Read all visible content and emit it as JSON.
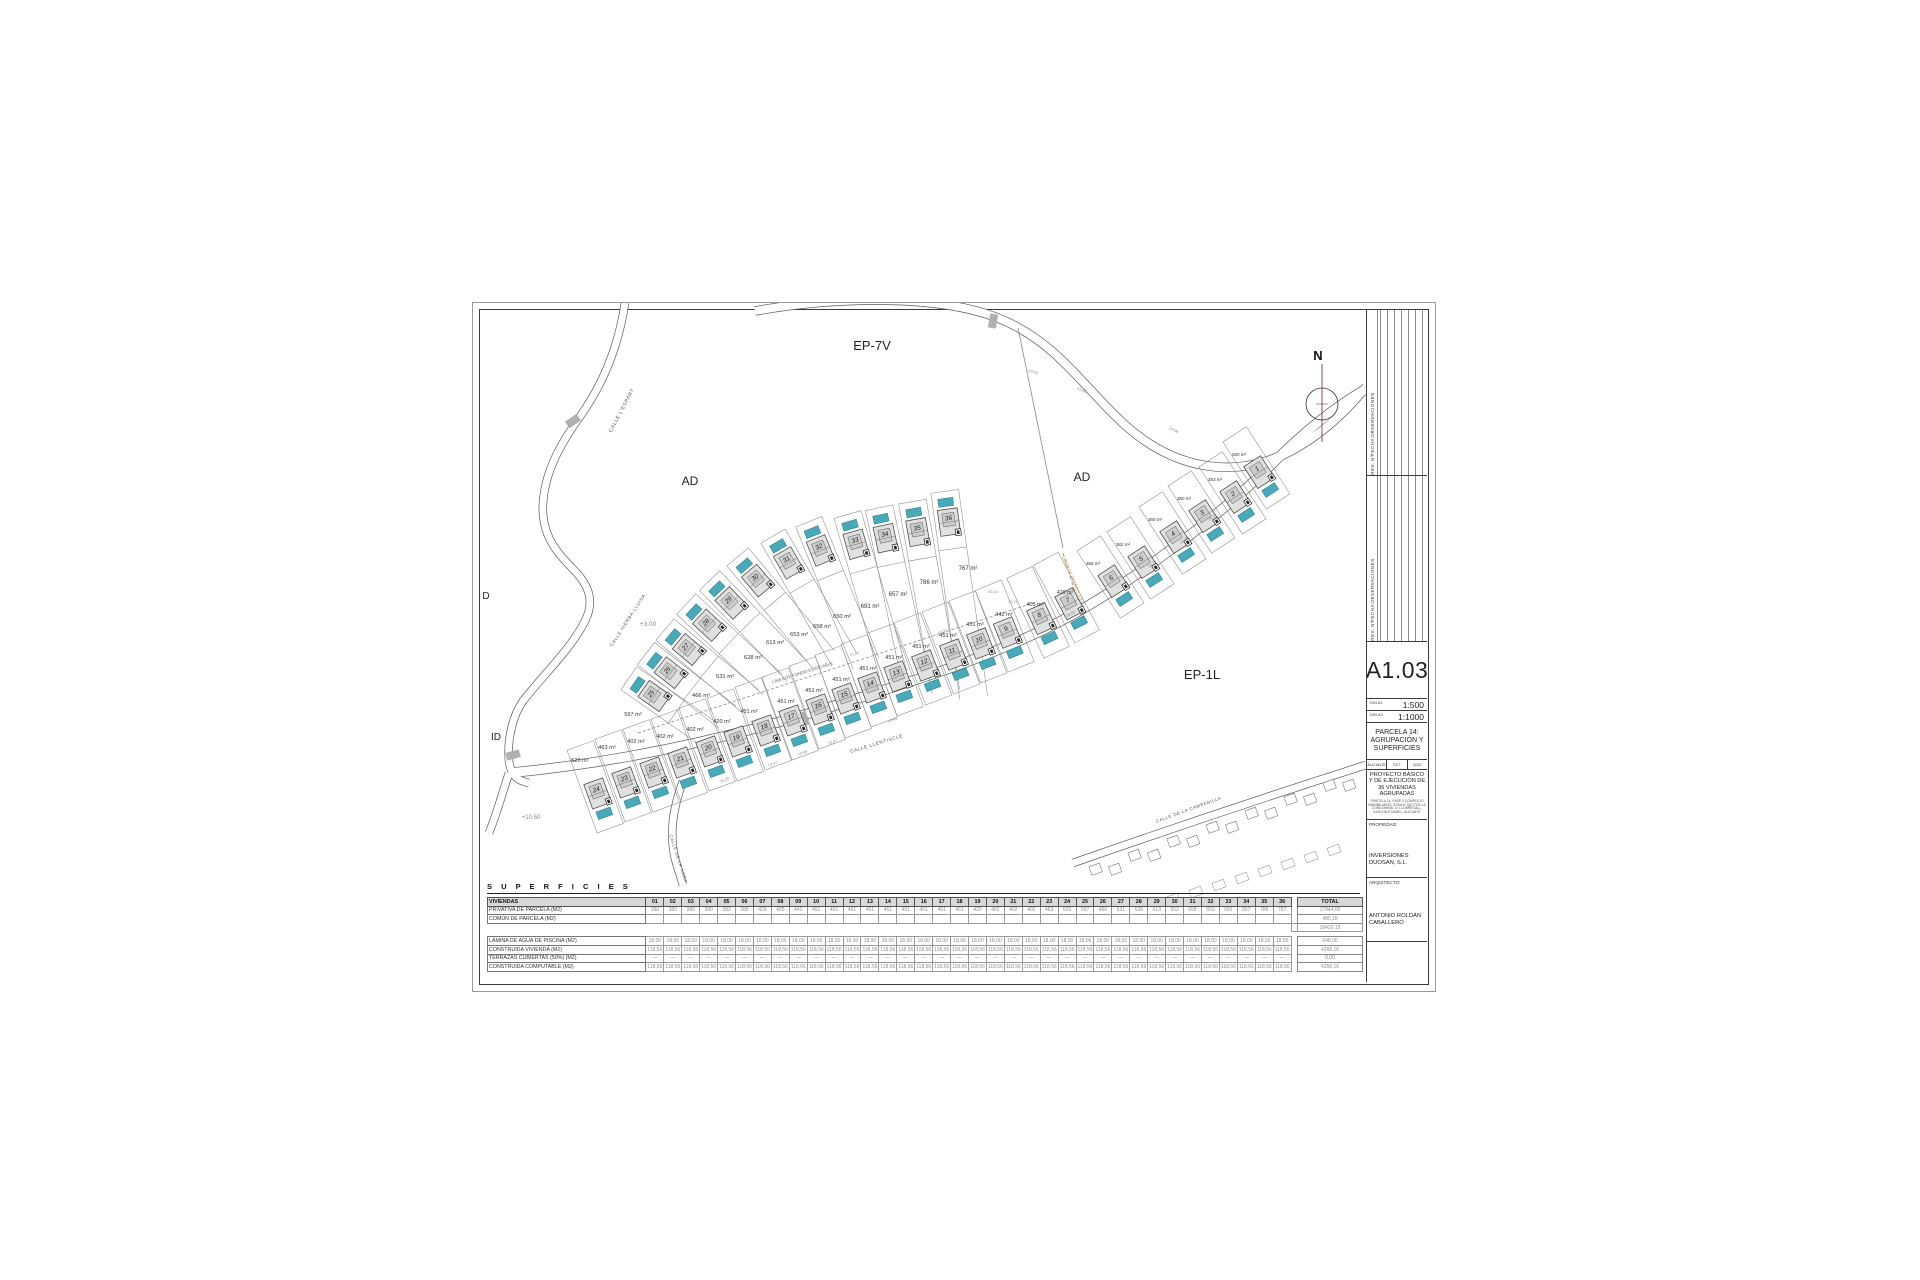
{
  "sheet": {
    "code": "A1.03",
    "scales": [
      {
        "din": "DIN A1",
        "value": "1:500"
      },
      {
        "din": "DIN A3",
        "value": "1:1000"
      }
    ],
    "drawing_title": "PARCELA 14: AGRUPACIÓN Y SUPERFICIES",
    "meta": [
      "ALICANTE",
      "OCT.",
      "2022"
    ],
    "project": "PROYECTO BÁSICO Y DE EJECUCIÓN DE 36 VIVIENDAS AGRUPADAS",
    "project_address": "PARCELA 14, FASE 3 COMPLEJO INMOBILIARIO, ZONA E SECTOR LA CONDOMINA, C/ LLOBREGALL, 03110 MUTXAMEL, ALICANTE",
    "owner_label": "PROPIEDAD:",
    "owner": "INVERSIONES DUOSAN, S.L.",
    "architect_label": "ARQUITECTO:",
    "architect": "ANTONIO ROLDÁN CABALLERO",
    "revision_headers": [
      "OBSERVACIONES",
      "FECHA",
      "REV. Nº"
    ]
  },
  "plan": {
    "colors": {
      "pool": "#4aa9b8",
      "pool_stroke": "#2e8492",
      "house_fill": "#e0e0e0",
      "line": "#3c3c3c",
      "parcel": "#8a8a8a",
      "accent_orange": "#c49a4a",
      "north_line": "#8b3a3a"
    },
    "north": {
      "x": 849,
      "y": 101,
      "label": "N"
    },
    "region_labels": [
      {
        "text": "EP-7V",
        "x": 399,
        "y": 47,
        "size": 13
      },
      {
        "text": "AD",
        "x": 217,
        "y": 182,
        "size": 12
      },
      {
        "text": "AD",
        "x": 609,
        "y": 178,
        "size": 12
      },
      {
        "text": "EP-1L",
        "x": 729,
        "y": 376,
        "size": 13
      },
      {
        "text": "ID",
        "x": 23,
        "y": 437,
        "size": 10
      },
      {
        "text": "D",
        "x": 13,
        "y": 296,
        "size": 10
      }
    ],
    "street_labels": [
      {
        "text": "CALLE  L'ESPART",
        "x": 150,
        "y": 108,
        "rot": -62,
        "size": 5
      },
      {
        "text": "CALLE HIERBA-LLUISA",
        "x": 156,
        "y": 318,
        "rot": -57,
        "size": 4.6
      },
      {
        "text": "CALLE LLENTISCLE",
        "x": 404,
        "y": 442,
        "rot": -17,
        "size": 4.8
      },
      {
        "text": "CALLE DE LA XARA",
        "x": 204,
        "y": 556,
        "rot": 72,
        "size": 4.4
      },
      {
        "text": "CALLE DE LA CAMPANILLA",
        "x": 716,
        "y": 508,
        "rot": -20,
        "size": 4.4
      }
    ],
    "annotations": [
      {
        "text": "LÍNEA DE FONDO EDIFICABLE",
        "x": 330,
        "y": 371,
        "rot": -17.5,
        "size": 4.4,
        "color": "#666666"
      },
      {
        "text": "LÍNEA DE RETRANQUEO",
        "x": 599,
        "y": 278,
        "rot": 68,
        "size": 4.4,
        "color": "#c49a4a"
      },
      {
        "text": "+3.00",
        "x": 175,
        "y": 323,
        "rot": 0,
        "size": 6.5,
        "color": "#888888"
      },
      {
        "text": "+10.50",
        "x": 58,
        "y": 516,
        "rot": 0,
        "size": 6,
        "color": "#888888"
      }
    ],
    "dims": [
      {
        "text": "13,47",
        "x": 300,
        "y": 462,
        "rot": -20
      },
      {
        "text": "13,46",
        "x": 330,
        "y": 451,
        "rot": -20
      },
      {
        "text": "13,47",
        "x": 360,
        "y": 440,
        "rot": -20
      },
      {
        "text": "15,25",
        "x": 252,
        "y": 478,
        "rot": -20
      },
      {
        "text": "13,41",
        "x": 420,
        "y": 418,
        "rot": -20
      },
      {
        "text": "16,02",
        "x": 560,
        "y": 70,
        "rot": 18
      },
      {
        "text": "13,50",
        "x": 608,
        "y": 88,
        "rot": 22
      },
      {
        "text": "14,08",
        "x": 700,
        "y": 128,
        "rot": 30
      },
      {
        "text": "16,19",
        "x": 740,
        "y": 215,
        "rot": -35
      },
      {
        "text": "16,28",
        "x": 712,
        "y": 238,
        "rot": -35
      },
      {
        "text": "16,22",
        "x": 680,
        "y": 262,
        "rot": -35
      },
      {
        "text": "18,55",
        "x": 598,
        "y": 312,
        "rot": -25
      },
      {
        "text": "20,24",
        "x": 520,
        "y": 290,
        "rot": 0
      },
      {
        "text": "11,72",
        "x": 540,
        "y": 300,
        "rot": 0
      },
      {
        "text": "13,27",
        "x": 470,
        "y": 330,
        "rot": -18
      },
      {
        "text": "21,81",
        "x": 382,
        "y": 352,
        "rot": -18
      }
    ],
    "roads": [
      {
        "d": "M152,0 C146,40 132,78 108,112 C88,140 72,168 70,200 C68,232 84,250 100,266 C116,282 122,298 112,318 C98,346 70,372 50,398 C40,412 34,436 36,458 C38,472 44,478 56,480",
        "w": 7
      },
      {
        "d": "M282,8 C360,-6 470,-10 532,18 C586,42 612,86 652,122 C700,165 760,178 818,148 C846,133 872,110 893,84",
        "w": 8
      },
      {
        "d": "M36,470 C140,460 250,438 370,400 C460,372 520,352 580,322 C620,302 660,275 700,245 C740,215 775,185 800,160 C830,130 860,105 893,86",
        "w": 9
      },
      {
        "d": "M210,478 C200,505 196,530 202,556 L210,582",
        "w": 7
      },
      {
        "d": "M600,560 C680,532 780,498 893,462",
        "w": 7
      },
      {
        "d": "M36,470 C30,488 24,510 16,530",
        "w": 7
      }
    ],
    "boundary_lines": [
      {
        "d": "M545,25 L590,245",
        "dash": ""
      },
      {
        "d": "M165,430 L560,300",
        "dash": "3,2"
      },
      {
        "d": "M590,250 L612,322",
        "dash": "4,2"
      }
    ],
    "crossings": [
      {
        "x": 100,
        "y": 118,
        "rot": 55
      },
      {
        "x": 520,
        "y": 18,
        "rot": 10
      },
      {
        "x": 40,
        "y": 452,
        "rot": 75
      },
      {
        "x": 330,
        "y": 416,
        "rot": -18
      }
    ],
    "rows": [
      {
        "name": "upper",
        "poolSide": -1,
        "parcel": [
          14,
          38,
          20
        ],
        "plots": [
          {
            "n": 25,
            "x": 187,
            "y": 397,
            "a": -55
          },
          {
            "n": 26,
            "x": 203,
            "y": 374,
            "a": -52
          },
          {
            "n": 27,
            "x": 221,
            "y": 351,
            "a": -50
          },
          {
            "n": 28,
            "x": 241,
            "y": 327,
            "a": -47
          },
          {
            "n": 29,
            "x": 263,
            "y": 305,
            "a": -44
          },
          {
            "n": 30,
            "x": 289,
            "y": 283,
            "a": -40
          },
          {
            "n": 31,
            "x": 319,
            "y": 266,
            "a": -30
          },
          {
            "n": 32,
            "x": 350,
            "y": 254,
            "a": -22
          },
          {
            "n": 33,
            "x": 385,
            "y": 248,
            "a": -16
          },
          {
            "n": 34,
            "x": 414,
            "y": 242,
            "a": -12
          },
          {
            "n": 35,
            "x": 446,
            "y": 236,
            "a": -10
          },
          {
            "n": 36,
            "x": 477,
            "y": 226,
            "a": -8
          }
        ],
        "tails": [
          40,
          45,
          52,
          60,
          68,
          76,
          84,
          95,
          108,
          120,
          135,
          150
        ]
      },
      {
        "name": "lower",
        "poolSide": 1,
        "parcel": [
          14,
          58,
          30
        ],
        "plots": [
          {
            "n": 24,
            "x": 127,
            "y": 497,
            "a": -20
          },
          {
            "n": 23,
            "x": 155,
            "y": 486,
            "a": -20
          },
          {
            "n": 22,
            "x": 183,
            "y": 476,
            "a": -20
          },
          {
            "n": 21,
            "x": 211,
            "y": 466,
            "a": -20
          },
          {
            "n": 20,
            "x": 239,
            "y": 455,
            "a": -20
          },
          {
            "n": 19,
            "x": 267,
            "y": 445,
            "a": -20
          },
          {
            "n": 18,
            "x": 295,
            "y": 434,
            "a": -20
          },
          {
            "n": 17,
            "x": 322,
            "y": 424,
            "a": -20
          },
          {
            "n": 16,
            "x": 349,
            "y": 413,
            "a": -20
          },
          {
            "n": 15,
            "x": 375,
            "y": 402,
            "a": -20
          },
          {
            "n": 14,
            "x": 401,
            "y": 391,
            "a": -20
          },
          {
            "n": 13,
            "x": 427,
            "y": 380,
            "a": -20
          },
          {
            "n": 12,
            "x": 455,
            "y": 369,
            "a": -21
          },
          {
            "n": 11,
            "x": 483,
            "y": 358,
            "a": -21
          },
          {
            "n": 10,
            "x": 510,
            "y": 347,
            "a": -21
          },
          {
            "n": 9,
            "x": 537,
            "y": 336,
            "a": -22
          },
          {
            "n": 8,
            "x": 571,
            "y": 322,
            "a": -25
          },
          {
            "n": 7,
            "x": 600,
            "y": 307,
            "a": -28
          }
        ]
      },
      {
        "name": "arm",
        "poolSide": 1,
        "parcel": [
          14,
          52,
          28
        ],
        "plots": [
          {
            "n": 6,
            "x": 644,
            "y": 284,
            "a": -33
          },
          {
            "n": 5,
            "x": 674,
            "y": 265,
            "a": -33
          },
          {
            "n": 4,
            "x": 706,
            "y": 240,
            "a": -33
          },
          {
            "n": 3,
            "x": 735,
            "y": 219,
            "a": -33
          },
          {
            "n": 2,
            "x": 766,
            "y": 200,
            "a": -33
          },
          {
            "n": 1,
            "x": 790,
            "y": 175,
            "a": -33
          }
        ]
      }
    ],
    "area_labels": [
      {
        "t": "520 m²",
        "x": 107,
        "y": 459,
        "s": 5.6
      },
      {
        "t": "463 m²",
        "x": 134,
        "y": 446,
        "s": 5.6
      },
      {
        "t": "402 m²",
        "x": 163,
        "y": 440,
        "s": 5.6
      },
      {
        "t": "402 m²",
        "x": 192,
        "y": 435,
        "s": 5.6
      },
      {
        "t": "402 m²",
        "x": 222,
        "y": 428,
        "s": 5.6
      },
      {
        "t": "420 m²",
        "x": 249,
        "y": 420,
        "s": 5.6
      },
      {
        "t": "451 m²",
        "x": 276,
        "y": 410,
        "s": 5.6
      },
      {
        "t": "451 m²",
        "x": 313,
        "y": 400,
        "s": 5.6
      },
      {
        "t": "451 m²",
        "x": 341,
        "y": 389,
        "s": 5.6
      },
      {
        "t": "451 m²",
        "x": 368,
        "y": 378,
        "s": 5.6
      },
      {
        "t": "451 m²",
        "x": 395,
        "y": 367,
        "s": 5.6
      },
      {
        "t": "451 m²",
        "x": 421,
        "y": 356,
        "s": 5.6
      },
      {
        "t": "451 m²",
        "x": 448,
        "y": 345,
        "s": 5.6
      },
      {
        "t": "451 m²",
        "x": 475,
        "y": 334,
        "s": 5.6
      },
      {
        "t": "451 m²",
        "x": 502,
        "y": 323,
        "s": 5.6
      },
      {
        "t": "442 m²",
        "x": 531,
        "y": 313,
        "s": 5.6
      },
      {
        "t": "405 m²",
        "x": 562,
        "y": 303,
        "s": 5.6
      },
      {
        "t": "429 m²",
        "x": 592,
        "y": 291,
        "s": 5.2
      },
      {
        "t": "597 m²",
        "x": 160,
        "y": 413,
        "s": 5.6
      },
      {
        "t": "466 m²",
        "x": 228,
        "y": 394,
        "s": 5.8
      },
      {
        "t": "531 m²",
        "x": 252,
        "y": 375,
        "s": 5.8
      },
      {
        "t": "628 m²",
        "x": 280,
        "y": 356,
        "s": 5.8
      },
      {
        "t": "613 m²",
        "x": 302,
        "y": 341,
        "s": 5.8
      },
      {
        "t": "653 m²",
        "x": 326,
        "y": 333,
        "s": 5.8
      },
      {
        "t": "658 m²",
        "x": 349,
        "y": 325,
        "s": 5.8
      },
      {
        "t": "650 m²",
        "x": 369,
        "y": 315,
        "s": 5.8
      },
      {
        "t": "691 m²",
        "x": 397,
        "y": 305,
        "s": 6
      },
      {
        "t": "657 m²",
        "x": 425,
        "y": 293,
        "s": 6
      },
      {
        "t": "786 m²",
        "x": 456,
        "y": 281,
        "s": 6
      },
      {
        "t": "767 m²",
        "x": 495,
        "y": 267,
        "s": 6
      },
      {
        "t": "390 m²",
        "x": 766,
        "y": 153,
        "s": 4.6
      },
      {
        "t": "383 m²",
        "x": 742,
        "y": 178,
        "s": 4.6
      },
      {
        "t": "380 m²",
        "x": 711,
        "y": 197,
        "s": 4.6
      },
      {
        "t": "380 m²",
        "x": 682,
        "y": 218,
        "s": 4.6
      },
      {
        "t": "382 m²",
        "x": 650,
        "y": 243,
        "s": 4.6
      },
      {
        "t": "388 m²",
        "x": 620,
        "y": 262,
        "s": 4.6
      }
    ]
  },
  "table": {
    "title": "S U P E R F I C I E S",
    "corner": "VIVIENDAS",
    "columns": [
      "01",
      "02",
      "03",
      "04",
      "05",
      "06",
      "07",
      "08",
      "09",
      "10",
      "11",
      "12",
      "13",
      "14",
      "15",
      "16",
      "17",
      "18",
      "19",
      "20",
      "21",
      "22",
      "23",
      "24",
      "25",
      "26",
      "27",
      "28",
      "29",
      "30",
      "31",
      "32",
      "33",
      "34",
      "35",
      "36"
    ],
    "total_label": "TOTAL",
    "rows": [
      {
        "label": "PRIVATIVA DE PARCELA (M2)",
        "values": [
          "390",
          "383",
          "380",
          "380",
          "382",
          "388",
          "429",
          "405",
          "442",
          "451",
          "451",
          "451",
          "451",
          "451",
          "451",
          "451",
          "451",
          "451",
          "420",
          "402",
          "402",
          "402",
          "463",
          "520",
          "597",
          "466",
          "531",
          "628",
          "613",
          "653",
          "658",
          "650",
          "691",
          "657",
          "786",
          "767"
        ],
        "total": "17944,00"
      },
      {
        "label": "COMÚN DE PARCELA (M2)",
        "fill": "",
        "total": "485,18"
      },
      {
        "label": "",
        "sum": true,
        "total": "18429,18"
      },
      {
        "spacer": true
      },
      {
        "label": "LÁMINA DE AGUA DE PISCINA (M2)",
        "fill": "18,00",
        "total": "648,00"
      },
      {
        "label": "CONSTRUIDA VIVIENDA (M2)",
        "fill": "118,56",
        "total": "4268,16"
      },
      {
        "label": "TERRAZAS CUBIERTAS (50%) (M2)",
        "fill": "—",
        "total": "0,00"
      },
      {
        "label": "CONSTRUIDA COMPUTABLE (M2)",
        "fill": "118,56",
        "total": "4268,16"
      }
    ]
  }
}
